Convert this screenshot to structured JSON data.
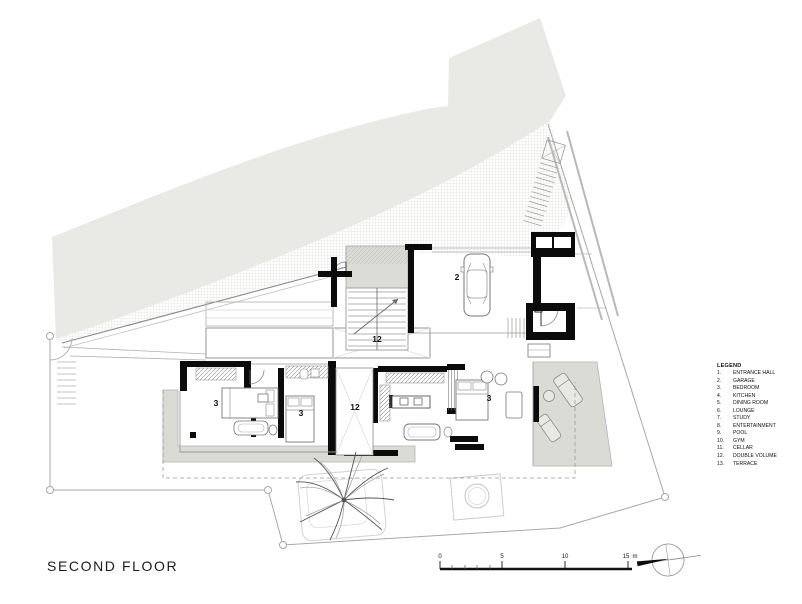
{
  "title": "SECOND FLOOR",
  "legend": {
    "heading": "LEGEND",
    "items": [
      {
        "num": "1.",
        "label": "ENTRANCE HALL"
      },
      {
        "num": "2.",
        "label": "GARAGE"
      },
      {
        "num": "3.",
        "label": "BEDROOM"
      },
      {
        "num": "4.",
        "label": "KITCHEN"
      },
      {
        "num": "5.",
        "label": "DINING ROOM"
      },
      {
        "num": "6.",
        "label": "LOUNGE"
      },
      {
        "num": "7.",
        "label": "STUDY"
      },
      {
        "num": "8.",
        "label": "ENTERTAINMENT"
      },
      {
        "num": "9.",
        "label": "POOL"
      },
      {
        "num": "10.",
        "label": "GYM"
      },
      {
        "num": "11.",
        "label": "CELLAR"
      },
      {
        "num": "12.",
        "label": "DOUBLE VOLUME"
      },
      {
        "num": "13.",
        "label": "TERRACE"
      }
    ]
  },
  "scale_bar": {
    "tick_labels": [
      "0",
      "5",
      "10",
      "15"
    ],
    "unit": "m"
  },
  "plan": {
    "room_labels": [
      {
        "text": "2"
      },
      {
        "text": "3"
      },
      {
        "text": "3"
      },
      {
        "text": "3"
      },
      {
        "text": "12"
      },
      {
        "text": "12"
      }
    ]
  },
  "colors": {
    "site_band": "#e9e9e6",
    "terrace": "#d9dbd4",
    "entry_paving": "#dcdcd7",
    "wall": "#0b0b0b",
    "boundary": "#a8a8a6"
  }
}
